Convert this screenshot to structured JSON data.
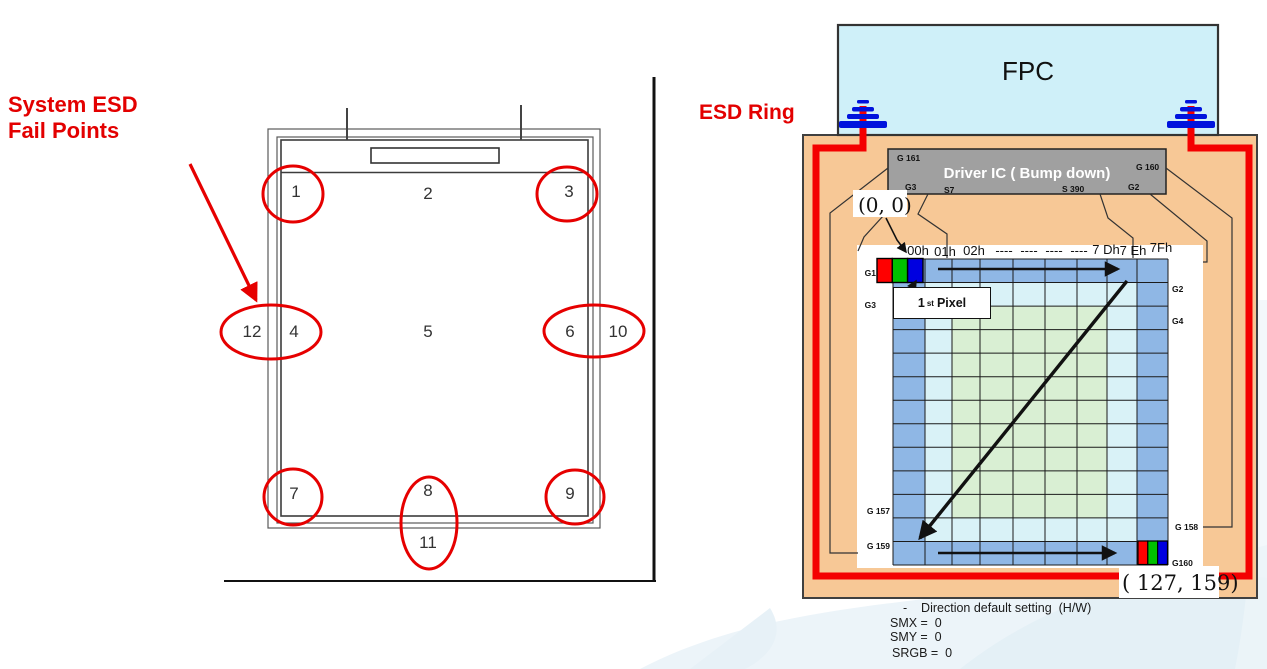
{
  "left_figure": {
    "title_line1": "System ESD",
    "title_line2": "Fail Points",
    "points": {
      "n1": "1",
      "n2": "2",
      "n3": "3",
      "n4": "4",
      "n5": "5",
      "n6": "6",
      "n7": "7",
      "n8": "8",
      "n9": "9",
      "n10": "10",
      "n11": "11",
      "n12": "12"
    }
  },
  "right_figure": {
    "esd_ring_label": "ESD Ring",
    "fpc_label": "FPC",
    "driver_ic": {
      "label": "Driver IC ( Bump down)",
      "pin_g161": "G 161",
      "pin_g160": "G 160",
      "pin_g3": "G3",
      "pin_s7": "S7",
      "pin_s390": "S 390",
      "pin_g2": "G2"
    },
    "origin_label": "(0, 0)",
    "end_label": "( 127, 159)",
    "first_pixel": {
      "num": "1",
      "sup": "st",
      "word": "Pixel"
    },
    "col_headers": [
      "00h",
      "01h",
      "02h",
      "----",
      "----",
      "----",
      "----",
      "7 Dh",
      "7 Eh",
      "7Fh"
    ],
    "row_labels_left": [
      "G1",
      "G3",
      "G 157",
      "G 159"
    ],
    "row_labels_right": [
      "G2",
      "G4",
      "G 158",
      "G160"
    ],
    "notes": [
      "-    Direction default setting  (H/W)",
      "SMX =  0",
      "SMY =  0",
      "SRGB =  0"
    ]
  },
  "colors": {
    "red": "#f40000",
    "circle_red": "#e60000",
    "blue_cell": "#8fb7e5",
    "cyan_cell": "#d9f2f7",
    "green_cell": "#d9efd3",
    "orange_panel": "#f7c896",
    "fpc_cyan": "#cff0f9",
    "ic_gray": "#a0a0a0",
    "ground_blue": "#0013dd",
    "rgb_r": "#ff0000",
    "rgb_g": "#00c000",
    "rgb_b": "#0000e0"
  }
}
